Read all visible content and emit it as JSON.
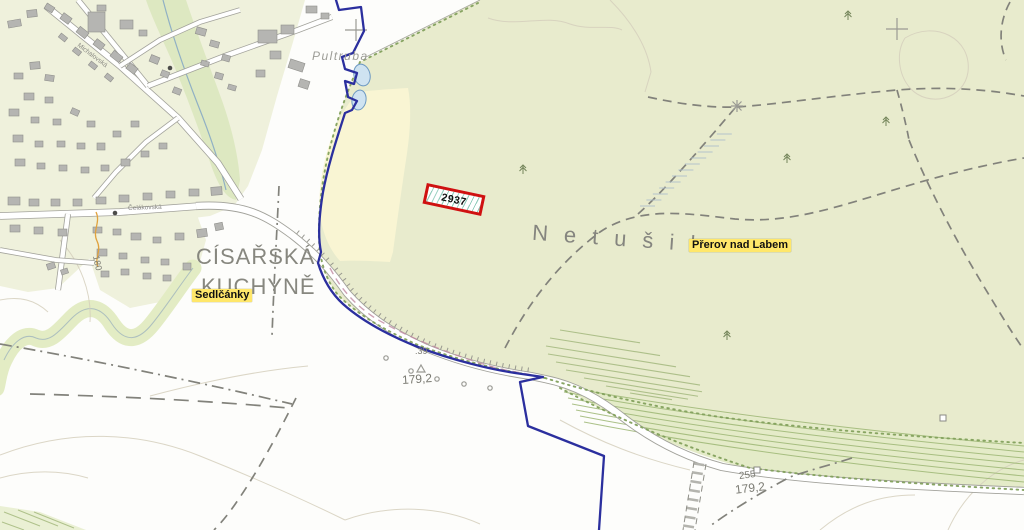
{
  "map": {
    "place_labels": {
      "pultruba": "Pultruba",
      "netusil": "Netušil",
      "cisarska_line1": "CÍSAŘSKÁ",
      "cisarska_line2": "KUCHYNĚ"
    },
    "highlight_labels": {
      "sedlcanky": "Sedlčánky",
      "prerov": "Přerov nad Labem"
    },
    "street_labels": {
      "celakovska": "Čelákovská",
      "michalovska": "Michalovská"
    },
    "elevation_labels": {
      "spot1_code": ".39",
      "spot1_value": "179,2",
      "spot2_code": "255",
      "spot2_value": "179,2",
      "contour_value": "180"
    },
    "parcel": {
      "number": "2937"
    },
    "symbols": {
      "grid_crosses": [
        [
          356,
          30
        ],
        [
          897,
          29
        ]
      ],
      "conifer_trees": [
        [
          523,
          174
        ],
        [
          848,
          20
        ],
        [
          886,
          126
        ],
        [
          787,
          163
        ],
        [
          727,
          340
        ]
      ],
      "star_landmark": [
        [
          737,
          106
        ]
      ],
      "boundary_stones": [
        [
          757,
          470
        ],
        [
          943,
          418
        ]
      ],
      "survey_triangle": [
        [
          421,
          369
        ]
      ],
      "small_circles": [
        [
          386,
          358
        ],
        [
          411,
          371
        ],
        [
          437,
          379
        ],
        [
          464,
          384
        ],
        [
          490,
          388
        ]
      ],
      "road_dots": [
        [
          115,
          213
        ],
        [
          170,
          68
        ]
      ]
    },
    "colors": {
      "forest": "#e8ebcd",
      "field": "#f9f5d3",
      "village": "#eff1dc",
      "riparian": "#dde8c1",
      "meander": "#e3ecc4",
      "strip": "#e4ebc8",
      "water": "#cfe3f1",
      "water_stroke": "#6d99c2",
      "boundary": "#2b2f9e",
      "highlight": "#ffe76a",
      "label_gray": "#85857f",
      "road_casing": "#a2a29b",
      "edge_dots": "#82a05c",
      "hatch": "#a6ba82",
      "building": "#b5b5b2",
      "building_stroke": "#90908c",
      "route_pink": "#c28ba3",
      "parcel_red": "#cf1110",
      "dash_gray": "#82827b",
      "contour": "#d5cfbc"
    }
  }
}
